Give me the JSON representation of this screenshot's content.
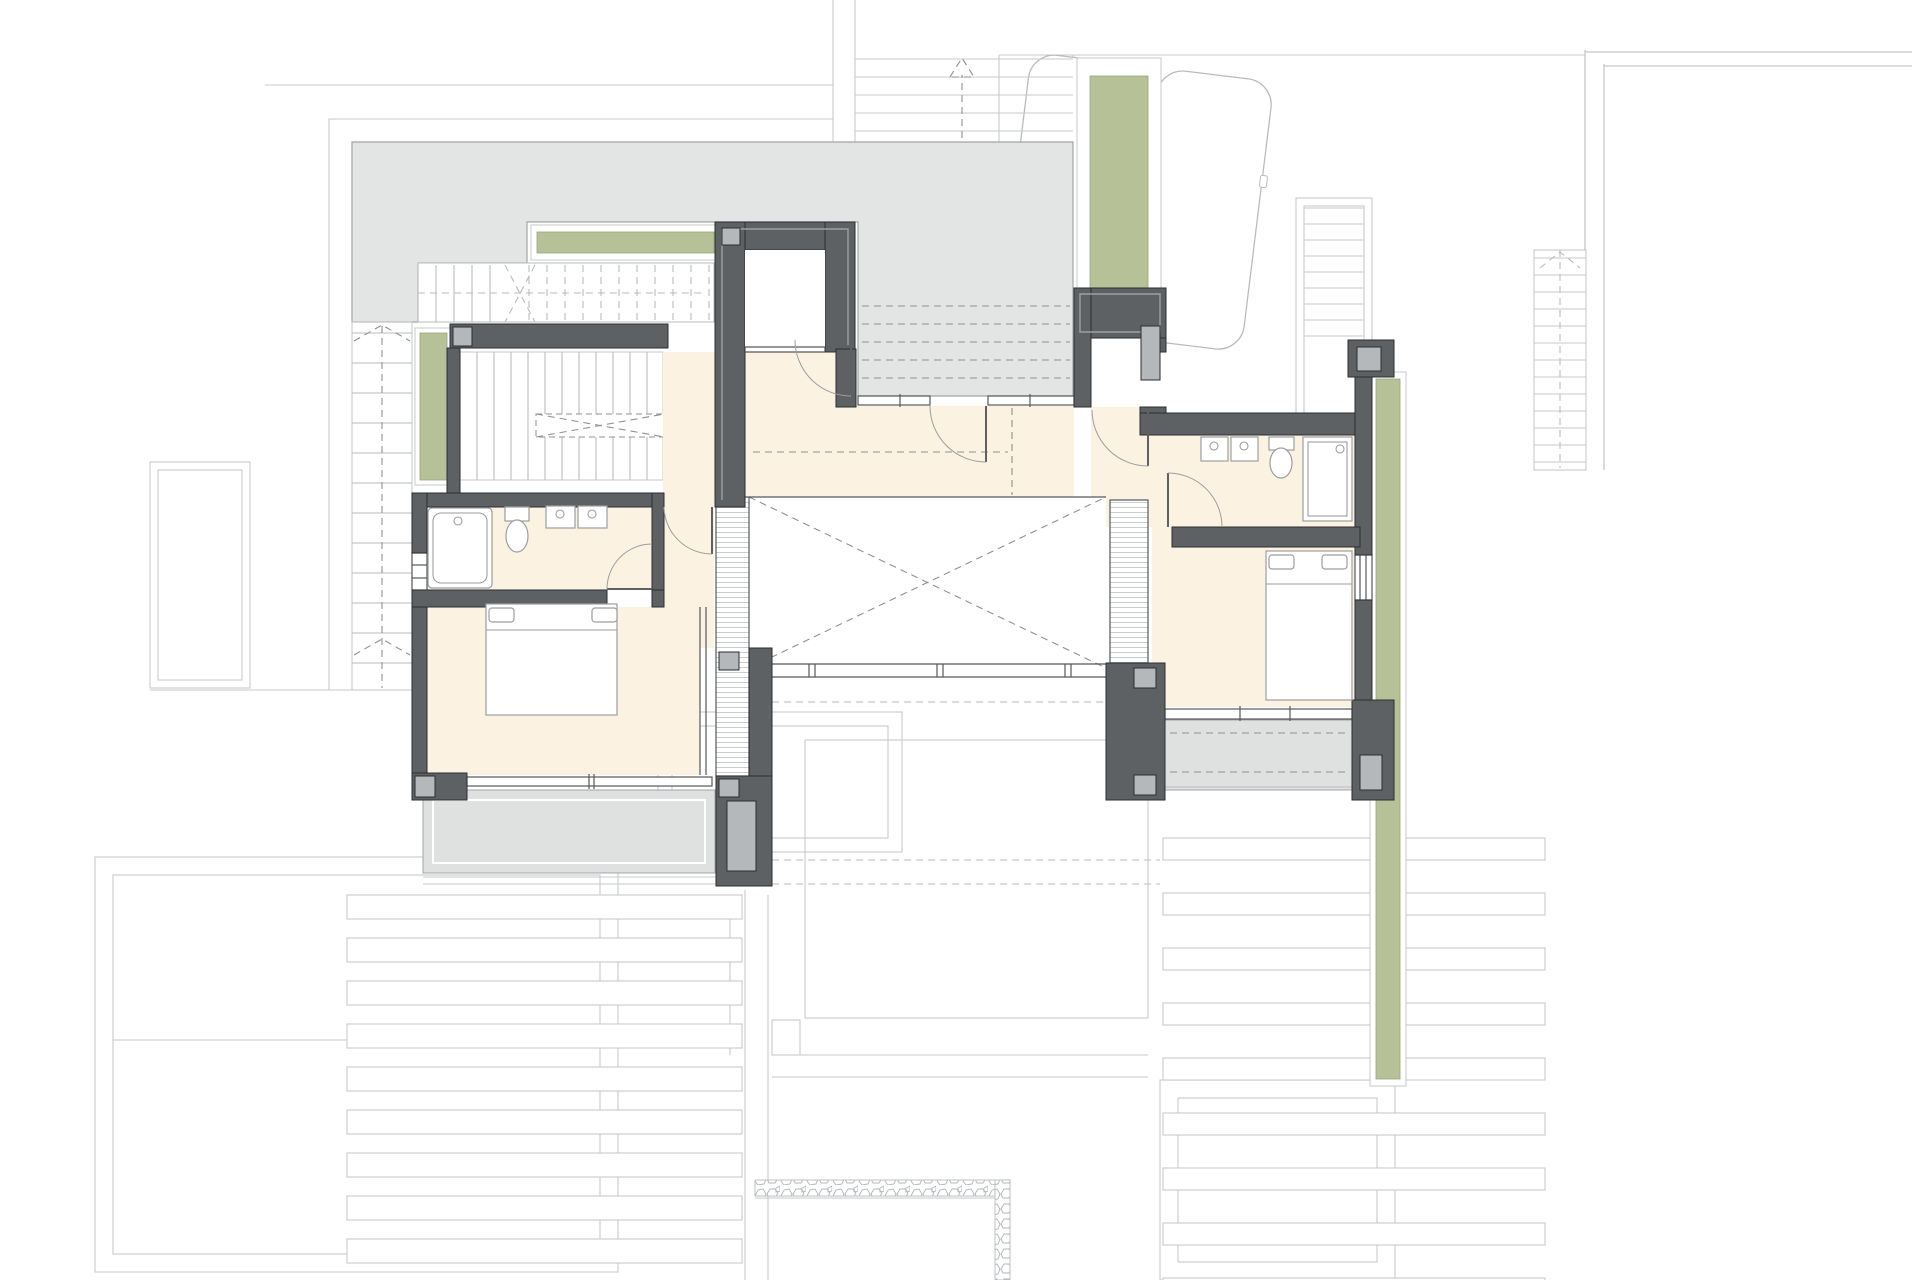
{
  "drawing": {
    "kind": "architectural-floor-plan",
    "level": "upper-floor",
    "visible_objects": [
      "bedroom",
      "bedroom",
      "bathroom",
      "bathroom",
      "double-bed",
      "double-bed",
      "bathtub",
      "shower",
      "toilet",
      "toilet",
      "washbasin-pair",
      "washbasin-pair",
      "stair",
      "stair",
      "stair",
      "stair",
      "stair",
      "stair",
      "terrace",
      "balcony",
      "balcony",
      "void-double-height",
      "planter",
      "planter",
      "planter",
      "planter",
      "car",
      "car",
      "swimming-pool",
      "pergola-louvers",
      "pergola-louvers"
    ]
  },
  "colors": {
    "wall": "#5e6163",
    "wall_edge": "#2c2e30",
    "wall_inner": "#9da0a2",
    "column": "#b5b8ba",
    "floor": "#fbf2e2",
    "terrace": "#e3e4e4",
    "terrace_edge": "#a2a5a7",
    "balcony": "#dfe0e0",
    "planter_green": "#b6c198",
    "planter_green_light": "#d2dab8",
    "planter_edge": "#99a47c",
    "faint_line": "#c7cacc",
    "faint_line2": "#b9bcbe",
    "dash_line": "#8e9193",
    "fixture_line": "#9b9ea0",
    "window_frame": "#55585a",
    "hatch_line": "#c9cccd"
  }
}
